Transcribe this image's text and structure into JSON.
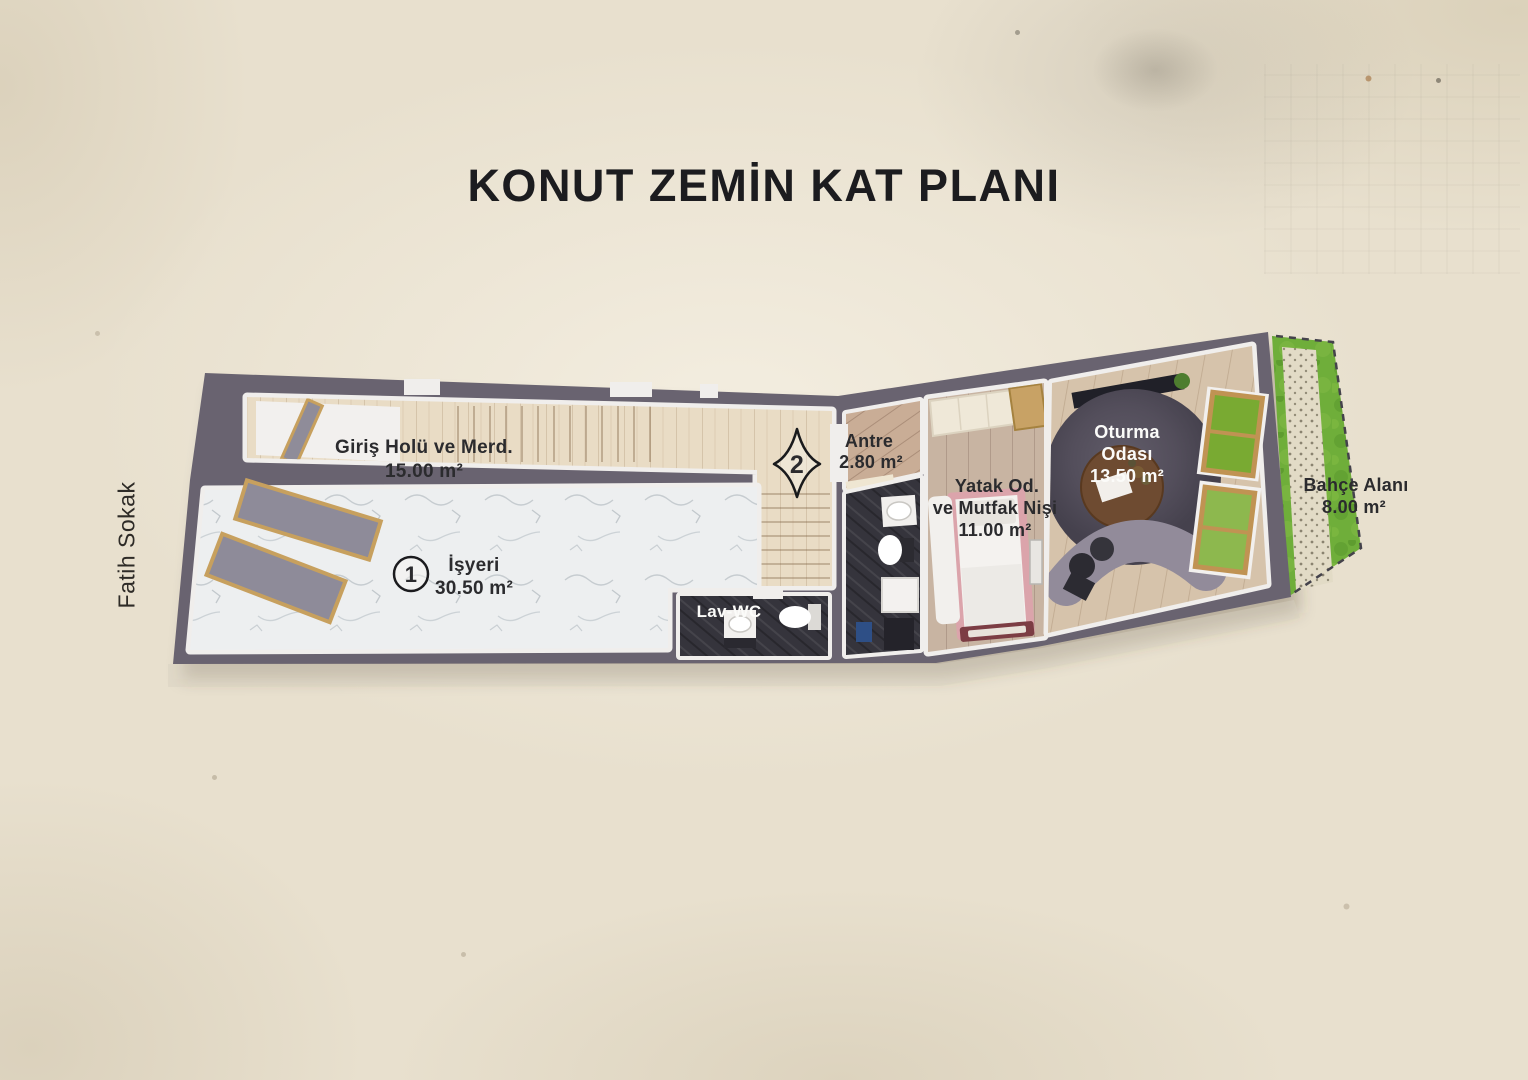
{
  "title": "KONUT ZEMİN KAT PLANI",
  "street_label": "Fatih Sokak",
  "markers": {
    "unit": "1",
    "section": "2"
  },
  "rooms": {
    "giris": {
      "name": "Giriş Holü ve Merd.",
      "area": "15.00 m²"
    },
    "isyeri": {
      "name": "İşyeri",
      "area": "30.50 m²"
    },
    "antre": {
      "name": "Antre",
      "area": "2.80 m²"
    },
    "lav_wc": {
      "name": "Lav-WC"
    },
    "yatak": {
      "name_line1": "Yatak Od.",
      "name_line2": "ve Mutfak Nişi",
      "area": "11.00 m²"
    },
    "oturma": {
      "name_line1": "Oturma",
      "name_line2": "Odası",
      "area": "13.50 m²"
    },
    "bahce": {
      "name": "Bahçe Alanı",
      "area": "8.00 m²"
    }
  },
  "colors": {
    "paper": "#e8e0ce",
    "wall": "#696370",
    "wall_lining": "#f0eeec",
    "wood_light": "#e9dcc5",
    "wood_antre": "#c9ad96",
    "wood_bedroom": "#c8b4a2",
    "wood_living": "#d6c3ab",
    "marble": "#edeff0",
    "dark_tile": "#35343c",
    "grass": "#6fae3a",
    "stone_path": "#e2dbc6",
    "window_frame": "#c09353",
    "window_glass_green": "#79aa32",
    "storefront_glass": "#8e8b99",
    "bed_frame_pink": "#dba4ab",
    "sofa": "#928b9a",
    "rug": "#534e5b",
    "label_ink": "#26262a"
  }
}
